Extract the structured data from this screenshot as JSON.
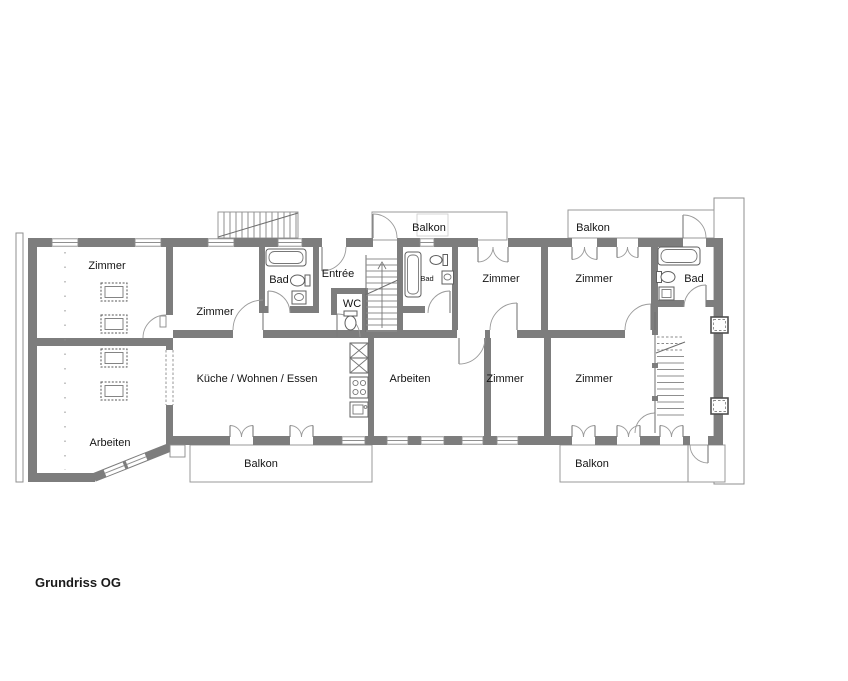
{
  "title": "Grundriss OG",
  "floor_plan": {
    "rooms": [
      {
        "name": "zimmer-nw",
        "label": "Zimmer"
      },
      {
        "name": "zimmer-w",
        "label": "Zimmer"
      },
      {
        "name": "bad-w",
        "label": "Bad"
      },
      {
        "name": "entree",
        "label": "Entrée"
      },
      {
        "name": "wc",
        "label": "WC"
      },
      {
        "name": "bad-m",
        "label": "Bad"
      },
      {
        "name": "zimmer-n1",
        "label": "Zimmer"
      },
      {
        "name": "zimmer-n2",
        "label": "Zimmer"
      },
      {
        "name": "bad-e",
        "label": "Bad"
      },
      {
        "name": "kueche-wohnen-essen",
        "label": "Küche / Wohnen / Essen"
      },
      {
        "name": "arbeiten-sw",
        "label": "Arbeiten"
      },
      {
        "name": "arbeiten-m",
        "label": "Arbeiten"
      },
      {
        "name": "zimmer-s1",
        "label": "Zimmer"
      },
      {
        "name": "zimmer-s2",
        "label": "Zimmer"
      }
    ],
    "balconies": [
      {
        "name": "balkon-top-left",
        "label": "Balkon"
      },
      {
        "name": "balkon-top-right",
        "label": "Balkon"
      },
      {
        "name": "balkon-bottom-left",
        "label": "Balkon"
      },
      {
        "name": "balkon-bottom-right",
        "label": "Balkon"
      }
    ],
    "fixture_icons": [
      "bathtub-icon",
      "toilet-icon",
      "sink-icon",
      "stove-icon",
      "kitchen-cabinet-icon",
      "staircase-icon",
      "chimney-icon",
      "bed-icon",
      "door-swing-icon",
      "window-icon"
    ],
    "colors": {
      "wall": "#7d7d7d",
      "outline": "#8f8f8f",
      "text": "#141414",
      "background": "#ffffff"
    }
  }
}
